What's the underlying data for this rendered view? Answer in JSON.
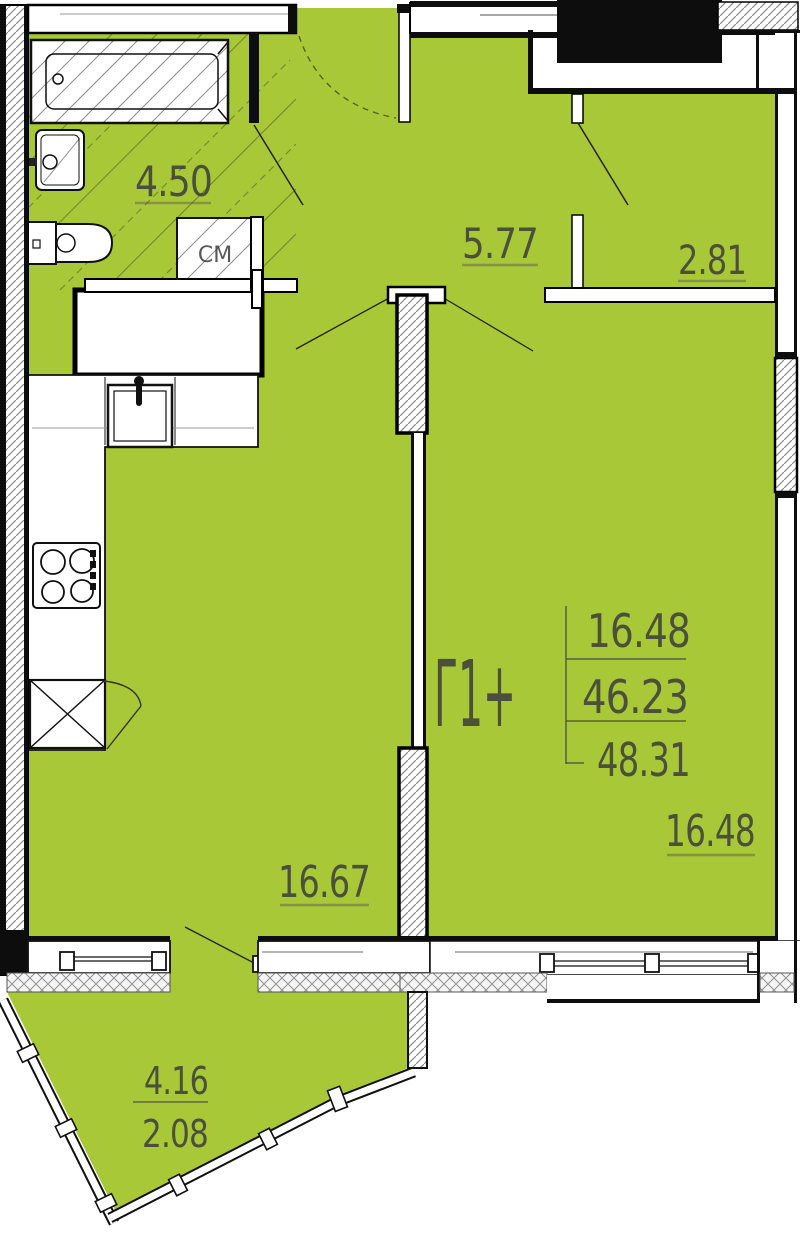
{
  "plan": {
    "apartment_label": "Г1+",
    "area_table": {
      "living_area": "16.48",
      "area_no_balcony": "46.23",
      "total_area": "48.31"
    },
    "rooms": {
      "bathroom": {
        "area": "4.50"
      },
      "hall": {
        "area": "5.77"
      },
      "closet": {
        "area": "2.81"
      },
      "living_kitchen": {
        "area": "16.67"
      },
      "bedroom": {
        "area": "16.48"
      },
      "balcony": {
        "area_full": "4.16",
        "area_coefficient": "2.08"
      }
    },
    "appliances": {
      "washing_machine": "СМ"
    },
    "colors": {
      "interior_green": "#a9c838",
      "wall_black": "#0d0d0d",
      "dimension_text": "#3b3b3b",
      "hatch_gray": "#8f8f8f"
    }
  }
}
